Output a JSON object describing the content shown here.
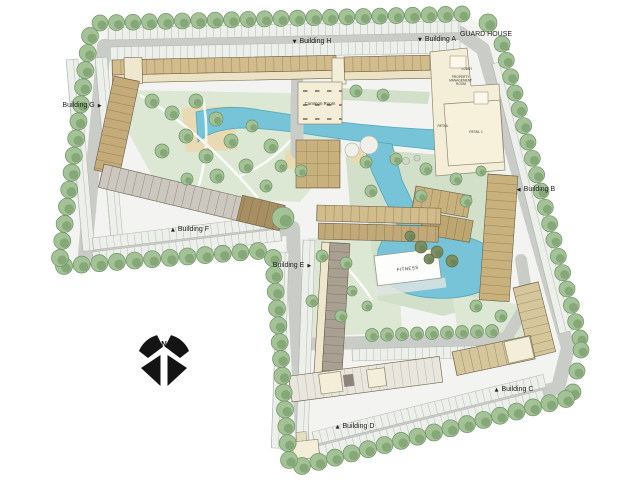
{
  "plan": {
    "type": "residential-masterplan-siteplan",
    "labels": {
      "building_h": {
        "marker": "▼",
        "text": "Building H"
      },
      "building_a": {
        "marker": "▼",
        "text": "Building A"
      },
      "building_b": {
        "marker": "◀",
        "text": "Building B"
      },
      "building_c": {
        "marker": "▲",
        "text": "Building C"
      },
      "building_d": {
        "marker": "▲",
        "text": "Building D"
      },
      "building_e": {
        "marker": "▶",
        "text": "Building E"
      },
      "building_f": {
        "marker": "▲",
        "text": "Building F"
      },
      "building_g": {
        "marker": "▶",
        "text": "Building G"
      },
      "guard_house": {
        "text": "GUARD HOUSE"
      },
      "common_room": {
        "text": "Common Room"
      },
      "lobby": {
        "text": "LOBBY"
      },
      "property_management_room": {
        "lines": [
          "PROPERTY",
          "MANAGEMENT",
          "ROOM"
        ]
      },
      "retail": {
        "text": "RETAIL"
      },
      "retail_1": {
        "text": "RETAIL 1"
      },
      "fitness": {
        "text": "FITNESS"
      },
      "north": {
        "text": "N"
      }
    },
    "colors": {
      "road": "#caccc8",
      "water": "#77c3d7",
      "water_edge": "#4fa8bf",
      "lawn": "#dce7d4",
      "sand": "#e9dab3",
      "cream": "#f4eed8",
      "tree": "#a3c295",
      "tree_edge": "#6d9267",
      "building_tan": "#d3bc8b",
      "building_khaki": "#c8b17c",
      "building_brown": "#a78f62",
      "building_taupe": "#a9a093",
      "building_gray": "#ccc8bf",
      "text": "#1f1f1f",
      "compass": "#141414"
    }
  }
}
